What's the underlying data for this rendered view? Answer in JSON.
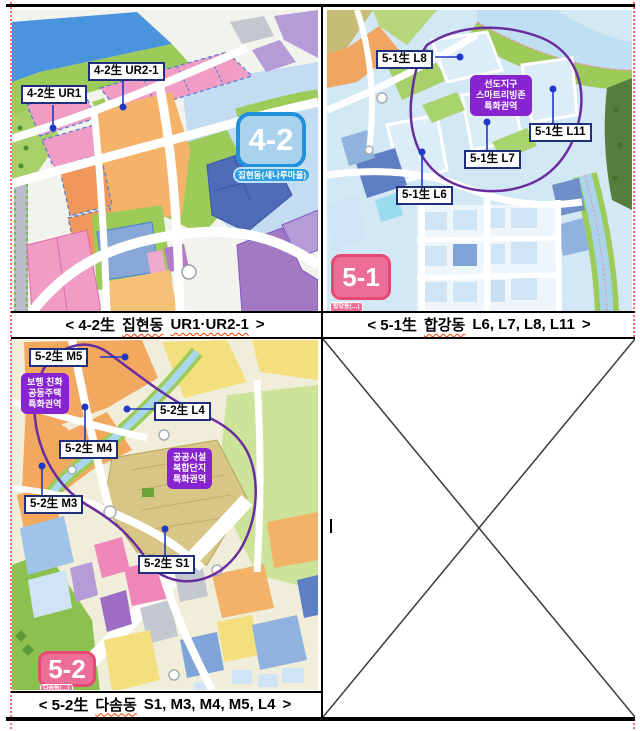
{
  "map42": {
    "label_ur21": "4-2生 UR2-1",
    "label_ur1": "4-2生 UR1",
    "badge": "4-2",
    "badge_sub": "집현동(새나루마을)",
    "caption": {
      "lead": "< 4-2生",
      "dong": "집현동",
      "codes": "UR1·UR2-1",
      "close": ">"
    }
  },
  "map51": {
    "label_l8": "5-1生 L8",
    "label_l11": "5-1生 L11",
    "label_l7": "5-1生 L7",
    "label_l6": "5-1生 L6",
    "zone": [
      "선도지구",
      "스마트리빙존",
      "특화권역"
    ],
    "badge": "5-1",
    "badge_sub": "합강동(…)",
    "caption": {
      "lead": "< 5-1生",
      "dong": "합강동",
      "codes": "L6, L7, L8, L11",
      "close": ">"
    }
  },
  "map52": {
    "label_m5": "5-2生 M5",
    "label_l4": "5-2生 L4",
    "label_m4": "5-2生 M4",
    "label_m3": "5-2生 M3",
    "label_s1": "5-2生 S1",
    "zone_walk": [
      "보행 친화",
      "공동주택",
      "특화권역"
    ],
    "zone_public": [
      "공공시설",
      "복합단지",
      "특화권역"
    ],
    "badge": "5-2",
    "badge_sub": "다솜동(…)",
    "caption": {
      "lead": "< 5-2生",
      "dong": "다솜동",
      "codes": "S1, M3, M4, M5, L4",
      "close": ">"
    }
  },
  "colors": {
    "zone_box": "#8824cf",
    "badge_blue_fill": "#a9d2ef",
    "badge_blue_border": "#2191dc",
    "badge_pink_fill": "#ec6d96",
    "badge_pink_border": "#e64a74",
    "label_border": "#1f2f7d",
    "pointer_dot": "#2038c8",
    "spellcheck": "#ff3c00"
  }
}
